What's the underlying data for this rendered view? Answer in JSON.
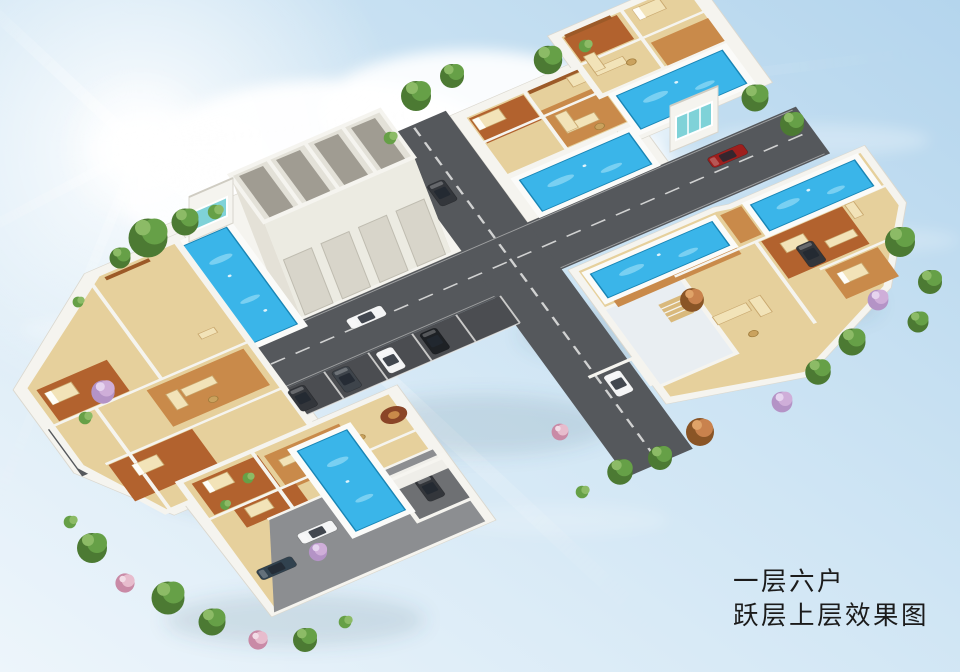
{
  "caption": {
    "line1": "一层六户",
    "line2": "跃层上层效果图"
  },
  "palette": {
    "sky_top": "#b4d5ed",
    "sky_mid": "#cfe5f4",
    "sky_bottom": "#edf5fb",
    "sun_glow": "#ffffff",
    "cloud": "#ffffff",
    "road": "#55585c",
    "road_line": "#e8e8e6",
    "pavement": "#8c8e91",
    "wall": "#f5f4ef",
    "wall_shade": "#d8d5cc",
    "roof_slab": "#e9eef2",
    "floor_tan": "#e6d09c",
    "floor_wood": "#b2622e",
    "floor_deck": "#c98a4a",
    "furniture": "#f2e3b8",
    "pool": "#3ab5e9",
    "pool_light": "#8fd9f4",
    "pool_coping": "#fbfbf9",
    "green_dark": "#4c7a33",
    "green_mid": "#66a047",
    "green_light": "#8cbb66",
    "autumn": "#c9824d",
    "blossom": "#cfaed9",
    "blossom_pink": "#e7bccd",
    "glass_teal": "#7fd2d8",
    "car_white": "#f4f5f6",
    "car_red": "#9e1f1d",
    "car_navy": "#31424f",
    "car_dark": "#33363b",
    "caption_text": "#1b1b1b"
  },
  "scene": {
    "type": "3d-aerial-floorplan-effect-render",
    "garage_door_count": 4,
    "garage_roof_cell_count": 4,
    "pool_count": 6,
    "cars": [
      {
        "color": "white",
        "location": "main-road"
      },
      {
        "color": "red",
        "location": "main-road-east"
      },
      {
        "color": "dark-gray",
        "location": "parking-bay-1"
      },
      {
        "color": "dark-gray",
        "location": "parking-bay-2"
      },
      {
        "color": "white",
        "location": "parking-bay-3"
      },
      {
        "color": "black",
        "location": "parking-bay-4"
      },
      {
        "color": "white",
        "location": "south-courtyard"
      },
      {
        "color": "navy",
        "location": "south-courtyard"
      },
      {
        "color": "dark-gray",
        "location": "south-courtyard-garage"
      },
      {
        "color": "white",
        "location": "east-wing-court"
      },
      {
        "color": "dark-gray",
        "location": "east-wing-court"
      },
      {
        "color": "dark-gray",
        "location": "north-lane"
      }
    ]
  }
}
